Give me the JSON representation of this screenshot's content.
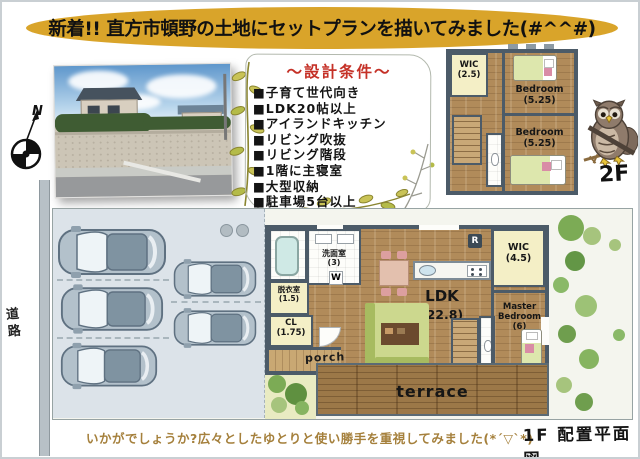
{
  "banner": {
    "text": "新着!! 直方市頓野の土地にセットプランを描いてみました(#^^#)"
  },
  "conditions": {
    "title": "～設計条件～",
    "items": [
      "■子育て世代向き",
      "■LDK20帖以上",
      "■アイランドキッチン",
      "■リビング吹抜",
      "■リビング階段",
      "■1階に主寝室",
      "■大型収納",
      "■駐車場5台以上"
    ]
  },
  "compass": {
    "north_label": "N"
  },
  "site": {
    "road_label": "道路"
  },
  "floor2": {
    "label": "2F",
    "wic": {
      "name": "WIC",
      "size": "(2.5)"
    },
    "bedroom_top": {
      "name": "Bedroom",
      "size": "(5.25)"
    },
    "bedroom_bottom": {
      "name": "Bedroom",
      "size": "(5.25)"
    }
  },
  "floor1": {
    "plan_label": "1F 配置平面図",
    "washroom": {
      "name": "洗面室",
      "size": "(3)"
    },
    "dressing": {
      "name": "脱衣室",
      "size": "(1.5)"
    },
    "closet": {
      "name": "CL",
      "size": "(1.75)"
    },
    "washer_label": "W",
    "fridge_label": "R",
    "ldk": {
      "name": "LDK",
      "size": "(22.8)"
    },
    "wic": {
      "name": "WIC",
      "size": "(4.5)"
    },
    "master_bedroom": {
      "name": "Master Bedroom",
      "size": "(6)"
    },
    "porch_label": "porch",
    "terrace_label": "terrace"
  },
  "footer": {
    "comment": "いかがでしょうか?広々としたゆとりと使い勝手を重視してみました(*´▽`*)"
  },
  "colors": {
    "banner_gold": "#d9a42a",
    "conditions_title_red": "#c53127",
    "wall_slate": "#4c5b68",
    "wood_floor": "#b18b5a",
    "terrace_wood": "#9c7848",
    "room_pale_yellow": "#f4efc6",
    "parking_blue_gray": "#dce3e9",
    "car_body": "#b3c1cb",
    "greenery_green": "#7cab55",
    "caption_brown": "#a5803c"
  }
}
